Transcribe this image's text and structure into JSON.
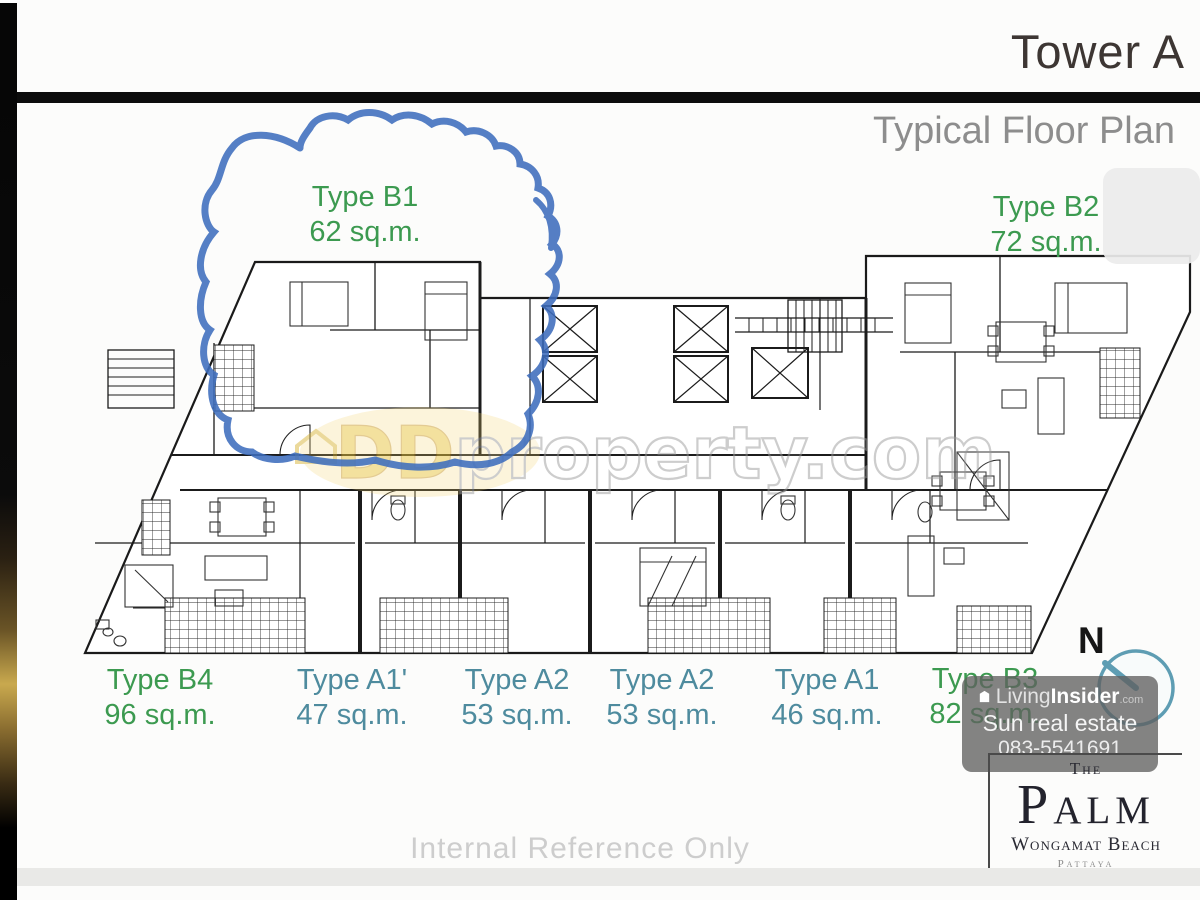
{
  "header": {
    "title": "Tower A",
    "subtitle": "Typical Floor Plan"
  },
  "units": [
    {
      "type": "Type B1",
      "area": "62 sq.m."
    },
    {
      "type": "Type B2",
      "area": "72 sq.m."
    },
    {
      "type": "Type B4",
      "area": "96 sq.m."
    },
    {
      "type": "Type A1'",
      "area": "47 sq.m."
    },
    {
      "type": "Type A2",
      "area": "53 sq.m."
    },
    {
      "type": "Type A2",
      "area": "53 sq.m."
    },
    {
      "type": "Type A1",
      "area": "46 sq.m."
    },
    {
      "type": "Type B3",
      "area": "82 sq.m."
    }
  ],
  "compass": {
    "north_label": "N"
  },
  "watermarks": {
    "ddproperty": {
      "prefix": "DD",
      "name": "property",
      "tld": ".com"
    },
    "livinginsider": {
      "brand_light": "Living",
      "brand_bold": "Insider",
      "tld": ".com",
      "agency": "Sun real estate",
      "phone": "083-5541691"
    }
  },
  "footer_note": "Internal Reference Only",
  "logo": {
    "the": "The",
    "name": "Palm",
    "location": "Wongamat Beach",
    "city": "Pattaya"
  },
  "colors": {
    "unit_type_b": "#3c9a50",
    "unit_type_a": "#4e8b9e",
    "marker_blue": "#3e6dbd",
    "compass_teal": "#5e9db3",
    "watermark_gold": "#e9c43f"
  }
}
